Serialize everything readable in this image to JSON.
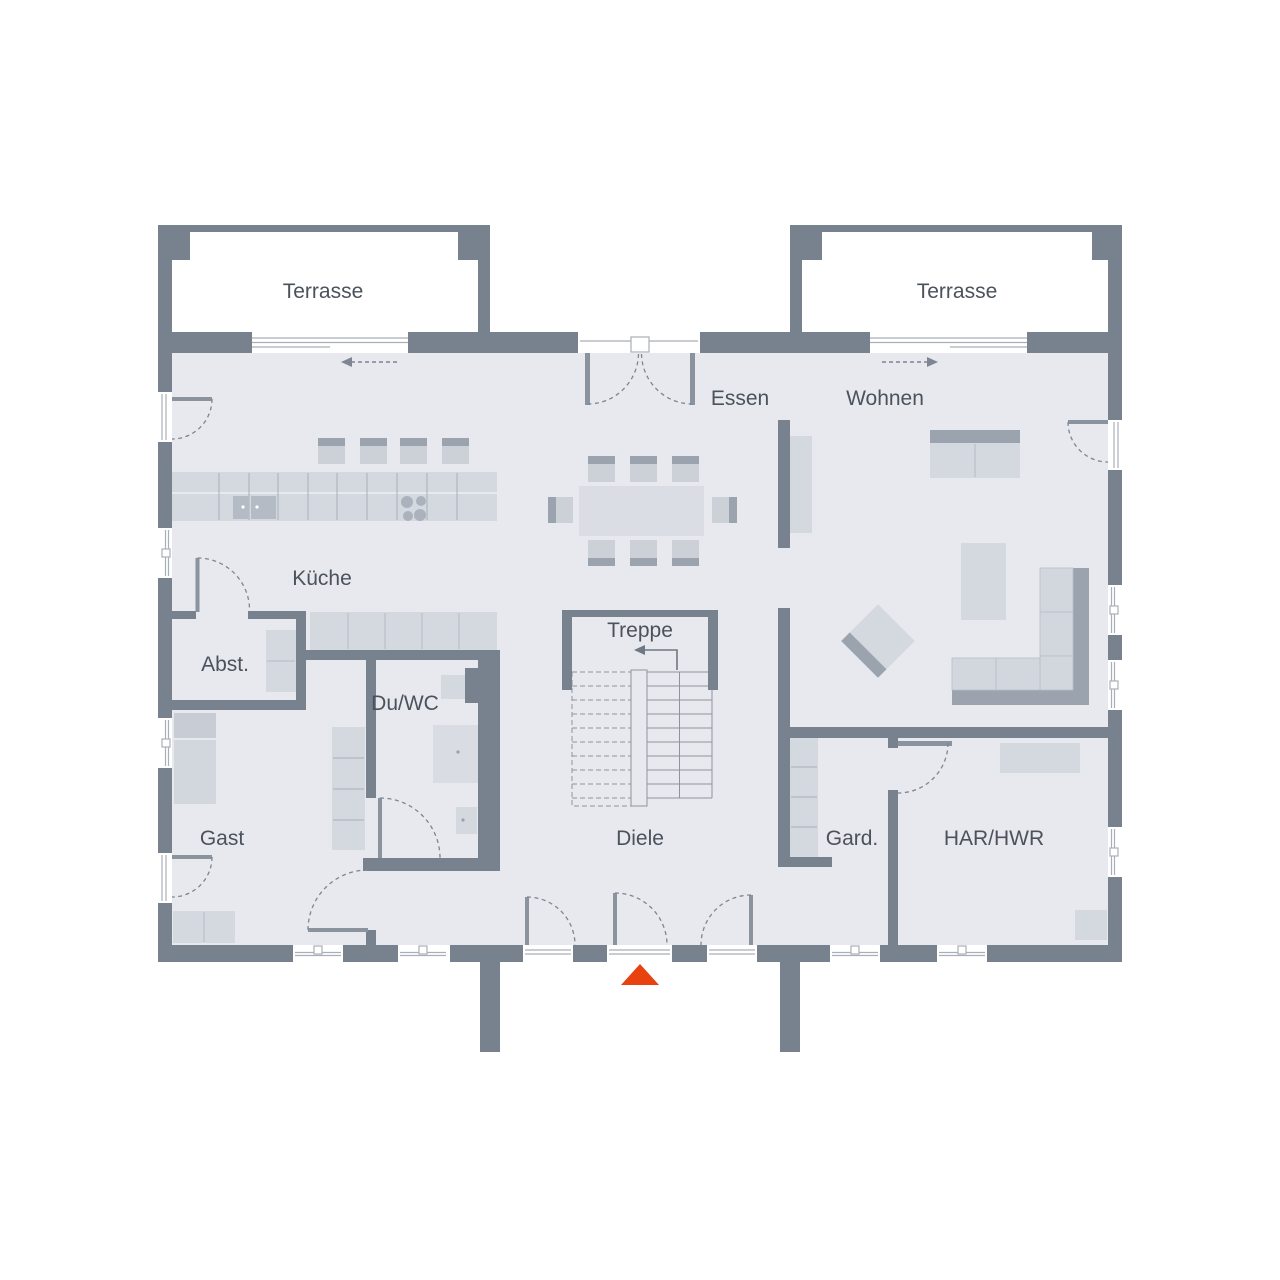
{
  "plan": {
    "title": "Erdgeschoss Grundriss",
    "labels": {
      "terrasse_left": "Terrasse",
      "terrasse_right": "Terrasse",
      "essen": "Essen",
      "wohnen": "Wohnen",
      "kueche": "Küche",
      "abstellraum": "Abst.",
      "du_wc": "Du/WC",
      "treppe": "Treppe",
      "gast": "Gast",
      "diele": "Diele",
      "garderobe": "Gard.",
      "har_hwr": "HAR/HWR"
    },
    "colors": {
      "wall": "#78828e",
      "floor": "#e7e9ee",
      "furniture_light": "#d4d8df",
      "furniture_mid": "#ccd1d8",
      "furniture_dark": "#9ba3ae",
      "text": "#4b525c",
      "entrance_marker": "#e8430f",
      "background": "#ffffff"
    },
    "icons": {
      "entrance_marker": "entrance-triangle",
      "slide_left": "slide-direction-arrow-left",
      "slide_right": "slide-direction-arrow-right",
      "stair_up": "stair-direction-arrow"
    }
  }
}
